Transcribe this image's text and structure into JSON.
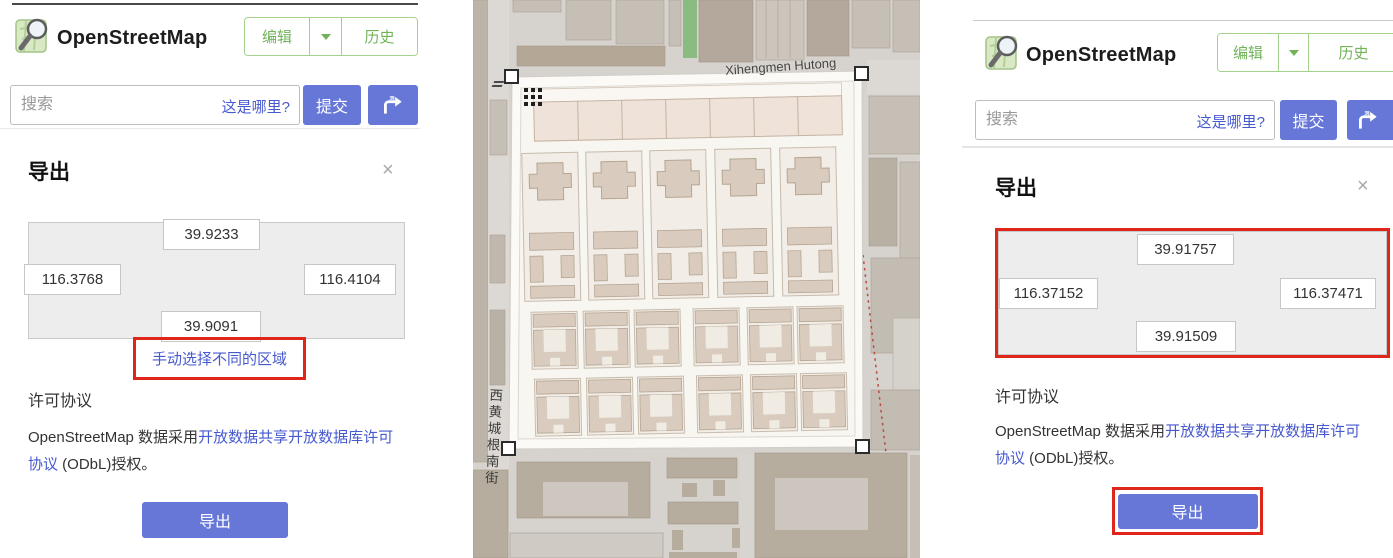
{
  "colors": {
    "accent_blue": "#6677d8",
    "brand_green": "#72b35a",
    "annotation_red": "#e0251b",
    "link_blue": "#4759cf"
  },
  "left_panel": {
    "brand": "OpenStreetMap",
    "nav": {
      "edit": "编辑",
      "history": "历史"
    },
    "search": {
      "placeholder": "搜索",
      "where_is_this": "这是哪里?",
      "submit": "提交"
    },
    "export": {
      "title": "导出",
      "close": "×",
      "bbox": {
        "north": "39.9233",
        "west": "116.3768",
        "east": "116.4104",
        "south": "39.9091"
      },
      "manual_select_link": "手动选择不同的区域",
      "license_heading": "许可协议",
      "license_prefix": "OpenStreetMap 数据采用",
      "license_link": "开放数据共享开放数据库许可协议",
      "license_suffix": " (ODbL)授权。",
      "export_button": "导出"
    }
  },
  "right_panel": {
    "brand": "OpenStreetMap",
    "nav": {
      "edit": "编辑",
      "history": "历史"
    },
    "search": {
      "placeholder": "搜索",
      "where_is_this": "这是哪里?",
      "submit": "提交"
    },
    "export": {
      "title": "导出",
      "close": "×",
      "bbox": {
        "north": "39.91757",
        "west": "116.37152",
        "east": "116.37471",
        "south": "39.91509"
      },
      "license_heading": "许可协议",
      "license_prefix": "OpenStreetMap 数据采用",
      "license_link": "开放数据共享开放数据库许可协议",
      "license_suffix": " (ODbL)授权。",
      "export_button": "导出"
    }
  },
  "map": {
    "street_top": "Xihengmen Hutong",
    "street_left": "西黄城根南街"
  }
}
